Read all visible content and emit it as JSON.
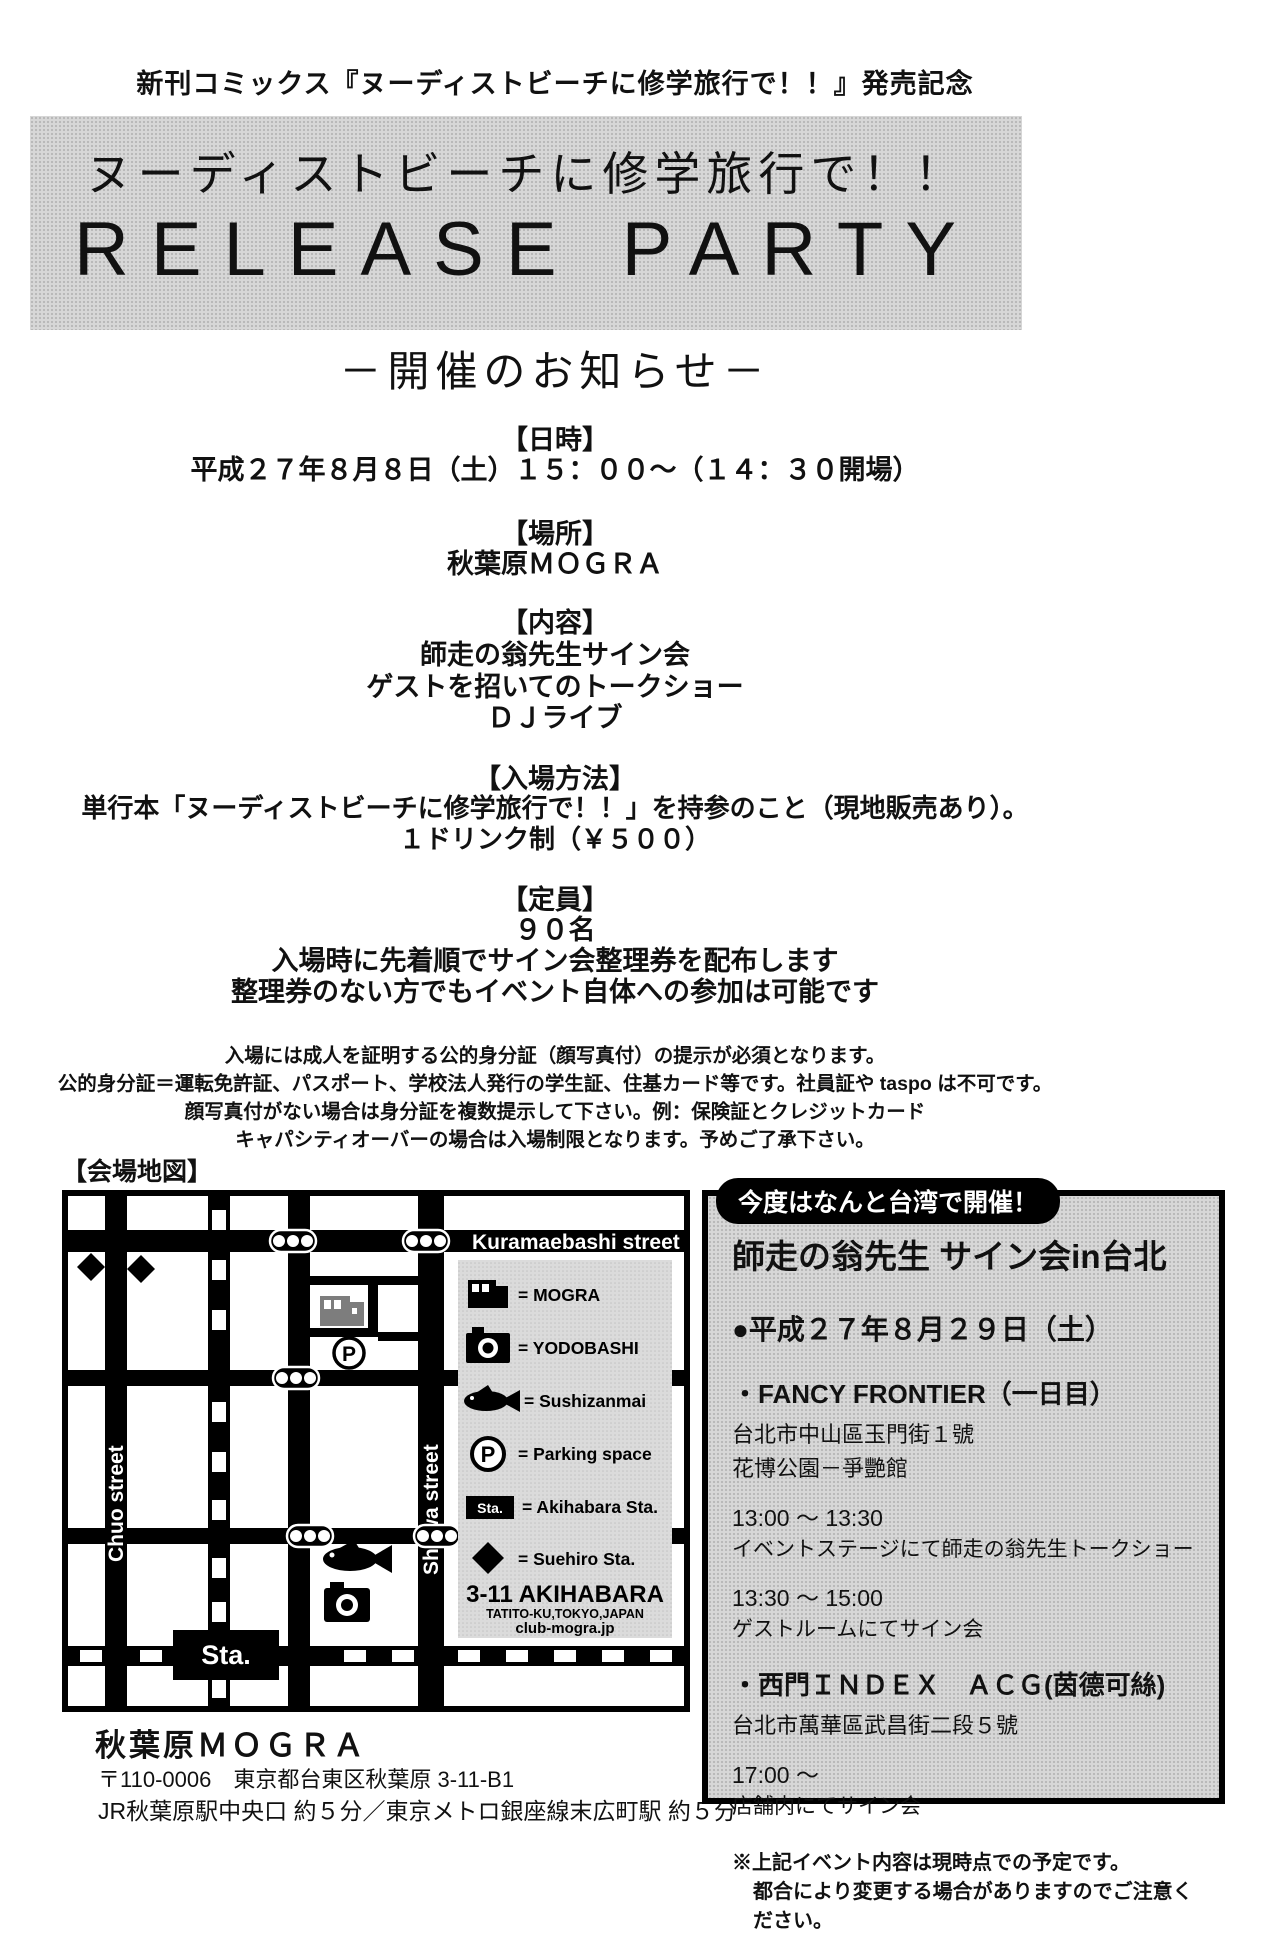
{
  "colors": {
    "ink": "#000000",
    "paper": "#ffffff",
    "halftone_gray": "#d7d7d7",
    "building_gray": "#7d7d7d"
  },
  "header": {
    "top_note": "新刊コミックス『ヌーディストビーチに修学旅行で！！』発売記念",
    "banner_line1": "ヌーディストビーチに修学旅行で！！",
    "banner_line2": "RELEASE PARTY",
    "subtitle": "－開催のお知らせ－"
  },
  "event": {
    "datetime_heading": "【日時】",
    "datetime": "平成２７年８月８日（土）１５：００～（１４：３０開場）",
    "place_heading": "【場所】",
    "place": "秋葉原ＭＯＧＲＡ",
    "contents_heading": "【内容】",
    "contents": [
      "師走の翁先生サイン会",
      "ゲストを招いてのトークショー",
      "ＤＪライブ"
    ],
    "entry_heading": "【入場方法】",
    "entry": [
      "単行本「ヌーディストビーチに修学旅行で！！」を持参のこと（現地販売あり）。",
      "１ドリンク制（￥５００）"
    ],
    "capacity_heading": "【定員】",
    "capacity": [
      "９０名",
      "入場時に先着順でサイン会整理券を配布します",
      "整理券のない方でもイベント自体への参加は可能です"
    ],
    "notes": [
      "入場には成人を証明する公的身分証（顔写真付）の提示が必須となります。",
      "公的身分証＝運転免許証、パスポート、学校法人発行の学生証、住基カード等です。社員証や taspo は不可です。",
      "顔写真付がない場合は身分証を複数提示して下さい。例：保険証とクレジットカード",
      "キャパシティオーバーの場合は入場制限となります。予めご了承下さい。"
    ]
  },
  "map": {
    "heading": "【会場地図】",
    "street_top": "Kuramaebashi street",
    "street_left": "Chuo street",
    "street_right": "Showa street",
    "station_label": "Sta.",
    "parking_letter": "P",
    "legend": [
      {
        "icon": "building-icon",
        "label": "= MOGRA"
      },
      {
        "icon": "camera-icon",
        "label": "= YODOBASHI"
      },
      {
        "icon": "fish-icon",
        "label": "= Sushizanmai"
      },
      {
        "icon": "parking-icon",
        "label": "= Parking space"
      },
      {
        "icon": "station-icon",
        "label": "= Akihabara Sta."
      },
      {
        "icon": "diamond-icon",
        "label": "= Suehiro Sta."
      }
    ],
    "address_block": [
      "3-11 AKIHABARA",
      "TATITO-KU,TOKYO,JAPAN",
      "club-mogra.jp"
    ]
  },
  "venue": {
    "name": "秋葉原ＭＯＧＲＡ",
    "postal": "〒110-0006　東京都台東区秋葉原 3-11-B1",
    "access": "JR秋葉原駅中央口 約５分／東京メトロ銀座線末広町駅 約５分"
  },
  "taiwan": {
    "badge": "今度はなんと台湾で開催！",
    "title": "師走の翁先生 サイン会in台北",
    "date": "●平成２７年８月２９日（土）",
    "ff_name": "・FANCY FRONTIER（一日目）",
    "ff_addr1": "台北市中山區玉門街１號",
    "ff_addr2": "花博公園－爭艷館",
    "ff_time1": "13:00 ～ 13:30",
    "ff_desc1": "イベントステージにて師走の翁先生トークショー",
    "ff_time2": "13:30 ～ 15:00",
    "ff_desc2": "ゲストルームにてサイン会",
    "index_name": "・西門ＩＮＤＥＸ　ＡＣＧ(茵德可絲)",
    "index_addr": "台北市萬華區武昌街二段５號",
    "index_time": "17:00 ～",
    "index_desc": "店舗内にてサイン会",
    "note1": "※上記イベント内容は現時点での予定です。",
    "note2": "都合により変更する場合がありますのでご注意ください。"
  }
}
